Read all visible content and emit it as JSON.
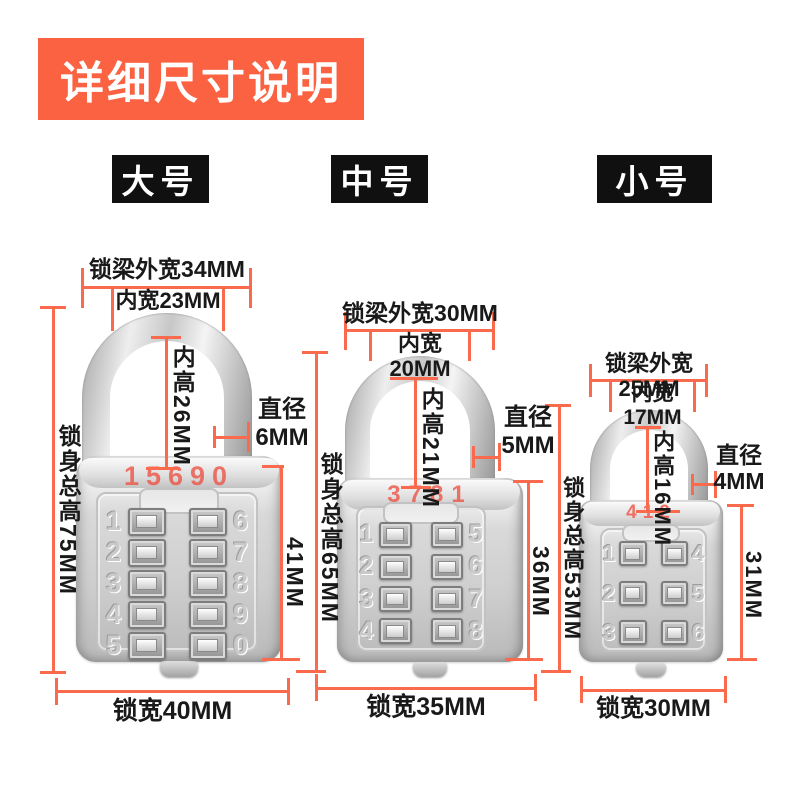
{
  "banner": {
    "title": "详细尺寸说明"
  },
  "tabs": [
    {
      "label": "大号"
    },
    {
      "label": "中号"
    },
    {
      "label": "小号"
    }
  ],
  "colors": {
    "accent": "#fa6242",
    "dim_line": "#fa6a4c",
    "tab_bg": "#101010",
    "code_red": "#ec5446"
  },
  "locks": [
    {
      "size": "大号",
      "code": "15690",
      "dims": {
        "shackle_outer": "锁梁外宽34MM",
        "inner_width": "内宽23MM",
        "inner_height": "内高26MM",
        "total_height": "锁身总高75MM",
        "diameter_label": "直径",
        "diameter_value": "6MM",
        "front_height": "41MM",
        "lock_width": "锁宽40MM"
      },
      "keypad": [
        [
          "1",
          "6"
        ],
        [
          "2",
          "7"
        ],
        [
          "3",
          "8"
        ],
        [
          "4",
          "9"
        ],
        [
          "5",
          "0"
        ]
      ]
    },
    {
      "size": "中号",
      "code": "3781",
      "dims": {
        "shackle_outer": "锁梁外宽30MM",
        "inner_width": "内宽20MM",
        "inner_height": "内高21MM",
        "total_height": "锁身总高65MM",
        "diameter_label": "直径",
        "diameter_value": "5MM",
        "front_height": "36MM",
        "lock_width": "锁宽35MM"
      },
      "keypad": [
        [
          "1",
          "5"
        ],
        [
          "2",
          "6"
        ],
        [
          "3",
          "7"
        ],
        [
          "4",
          "8"
        ]
      ]
    },
    {
      "size": "小号",
      "code": "412",
      "dims": {
        "shackle_outer": "锁梁外宽25MM",
        "inner_width": "内宽17MM",
        "inner_height": "内高16MM",
        "total_height": "锁身总高53MM",
        "diameter_label": "直径",
        "diameter_value": "4MM",
        "front_height": "31MM",
        "lock_width": "锁宽30MM"
      },
      "keypad": [
        [
          "1",
          "4"
        ],
        [
          "2",
          "5"
        ],
        [
          "3",
          "6"
        ]
      ]
    }
  ]
}
